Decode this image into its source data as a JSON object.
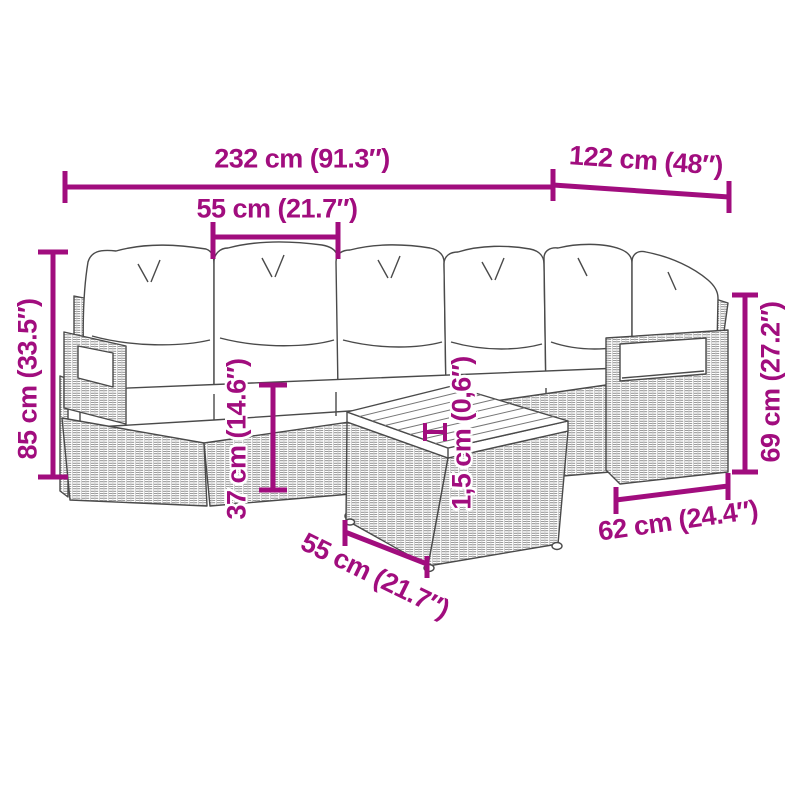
{
  "diagram": {
    "kind": "furniture-dimension-diagram",
    "illustration": "rattan-garden-lounge-set-with-cushions-and-coffee-table"
  },
  "colors": {
    "dimension_accent": "#a10d7e",
    "outline": "#4a4a4a",
    "cushion_fill": "#ffffff"
  },
  "labels": {
    "total_width": "232 cm (91.3″)",
    "right_section_width": "122 cm (48″)",
    "seat_width": "55 cm (21.7″)",
    "total_height": "85 cm (33.5″)",
    "seat_height": "37 cm (14.6″)",
    "tabletop_thickness": "1,5 cm (0,6″)",
    "table_width": "55 cm (21.7″)",
    "section_depth": "62 cm (24.4″)",
    "armrest_height": "69 cm (27.2″)"
  }
}
